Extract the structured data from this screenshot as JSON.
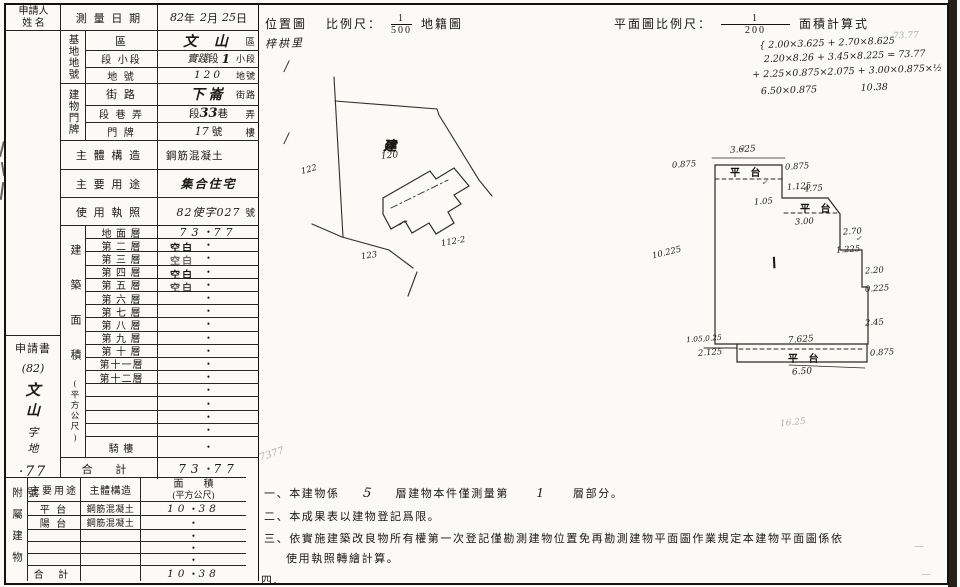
{
  "applicant": {
    "l1": "申請人",
    "l2": "姓 名"
  },
  "margin": {
    "doc": "申請書",
    "yr": "(82)",
    "n1": "文",
    "n2": "山",
    "n3": "字",
    "n4": "地",
    "no": "·77",
    "sfx": "號"
  },
  "rows": {
    "survey": {
      "label": "測 量 日 期",
      "h1": "82",
      "t1": "年",
      "h2": "2",
      "t2": "月",
      "h3": "25",
      "t3": "日"
    },
    "site": {
      "group": "基地地號",
      "r1": {
        "label": "區",
        "h": "文 山",
        "s": "區"
      },
      "r2": {
        "label": "段 小段",
        "h1": "實踐",
        "t1": "段",
        "h2": "1",
        "s": "小段"
      },
      "r3": {
        "label": "地 號",
        "h": "120",
        "s": "地號"
      }
    },
    "bldg": {
      "group": "建物門牌",
      "r1": {
        "label": "街 路",
        "h": "下崙",
        "s": "街路"
      },
      "r2": {
        "label": "段 巷 弄",
        "t1": "段",
        "h": "33",
        "t2": "巷",
        "s": "弄"
      },
      "r3": {
        "label": "門 牌",
        "h": "17",
        "t1": "號",
        "s": "樓"
      }
    },
    "structure": {
      "label": "主 體 構 造",
      "v": "鋼筋混凝土"
    },
    "usage": {
      "label": "主 要 用 途",
      "v": "集合住宅"
    },
    "license": {
      "label": "使 用 執 照",
      "h": "82使字027",
      "s": "號"
    }
  },
  "area": {
    "group": "建築面積",
    "unit": "(平方公尺)",
    "layers": [
      {
        "label": "地 面 層",
        "pre": "73",
        "dot": "•",
        "post": "77"
      },
      {
        "label": "第 二 層",
        "stamp": "空白",
        "dot": "•"
      },
      {
        "label": "第 三 層",
        "stamp": "空白",
        "dot": "•"
      },
      {
        "label": "第 四 層",
        "stamp": "空白",
        "dot": "•"
      },
      {
        "label": "第 五 層",
        "stamp": "空白",
        "dot": "•"
      },
      {
        "label": "第 六 層",
        "dot": "•"
      },
      {
        "label": "第 七 層",
        "dot": "•"
      },
      {
        "label": "第 八 層",
        "dot": "•"
      },
      {
        "label": "第 九 層",
        "dot": "•"
      },
      {
        "label": "第 十 層",
        "dot": "•"
      },
      {
        "label": "第十一層",
        "dot": "•"
      },
      {
        "label": "第十二層",
        "dot": "•"
      },
      {
        "label": "",
        "dot": "•"
      },
      {
        "label": "",
        "dot": "•"
      },
      {
        "label": "",
        "dot": "•"
      },
      {
        "label": "",
        "dot": "•"
      },
      {
        "label": "騎 樓",
        "dot": "•"
      }
    ],
    "total": {
      "label": "合 計",
      "pre": "73",
      "dot": "•",
      "post": "77"
    }
  },
  "annex": {
    "side": "附屬建物",
    "head": {
      "use": "主要用途",
      "struct": "主體構造",
      "a1": "面　　積",
      "a2": "(平方公尺)"
    },
    "rows": [
      {
        "use": "平 台",
        "struct": "鋼筋混凝土",
        "pre": "10",
        "dot": "•",
        "post": "38"
      },
      {
        "use": "陽 台",
        "struct": "鋼筋混凝土",
        "pre": "",
        "dot": "•",
        "post": ""
      },
      {
        "use": "",
        "struct": "",
        "pre": "",
        "dot": "•",
        "post": ""
      },
      {
        "use": "",
        "struct": "",
        "pre": "",
        "dot": "•",
        "post": ""
      },
      {
        "use": "",
        "struct": "",
        "pre": "",
        "dot": "•",
        "post": ""
      }
    ],
    "total": {
      "label": "合 計",
      "pre": "10",
      "dot": "•",
      "post": "38"
    }
  },
  "locmap": {
    "title": "位置圖",
    "scale_label": "比例尺：",
    "num": "1",
    "den": "500",
    "kind": "地籍圖",
    "village": "梓栱里",
    "bldg_mark": "建",
    "bldg_no": "120",
    "p_left": "122",
    "p_bottom": "123",
    "p_right": "112-2"
  },
  "plan": {
    "title": "平面圖比例尺：",
    "num": "1",
    "den": "200",
    "calc_title": "面積計算式",
    "calc": [
      "{ 2.00×3.625 + 2.70×8.625",
      "2.20×8.26 + 3.45×8.225 = 73.77",
      "+ 2.25×0.875×2.075 + 3.00×0.875×½",
      "6.50×0.875 　 10.38"
    ],
    "calc_faint": "73.77",
    "room": "Ⅰ",
    "dims": {
      "top": "3.625",
      "tl": "0.875",
      "p1": "平 台",
      "tr": "0.875",
      "v1125": "1.125",
      "d475": "4.75",
      "d105": "1.05",
      "p2": "平 台",
      "d300": "3.00",
      "d270": "2.70",
      "d1225": "1.225",
      "d220": "2.20",
      "d0225": "0.225",
      "d245": "2.45",
      "left": "10.225",
      "bl": "1.05,0.25",
      "d2125": "2.125",
      "d7625": "7.625",
      "p3": "平 台",
      "br": "0.875",
      "bottom": "6.50",
      "faint": "16.25"
    },
    "check": "✓"
  },
  "notes": {
    "faint": "7377",
    "n1a": "一、本建物係",
    "n1h1": "5",
    "n1b": "層建物本件僅測量第",
    "n1h2": "1",
    "n1c": "層部分。",
    "n2": "二、本成果表以建物登記爲限。",
    "n3a": "三、依實施建築改良物所有權第一次登記僅勘測建物位置免再勘測建物平面圖作業規定本建物平面圖係依",
    "n3b": "使用執照轉繪計算。",
    "n4": "四、"
  },
  "marks": {
    "slash": "/",
    "dash": "—"
  }
}
